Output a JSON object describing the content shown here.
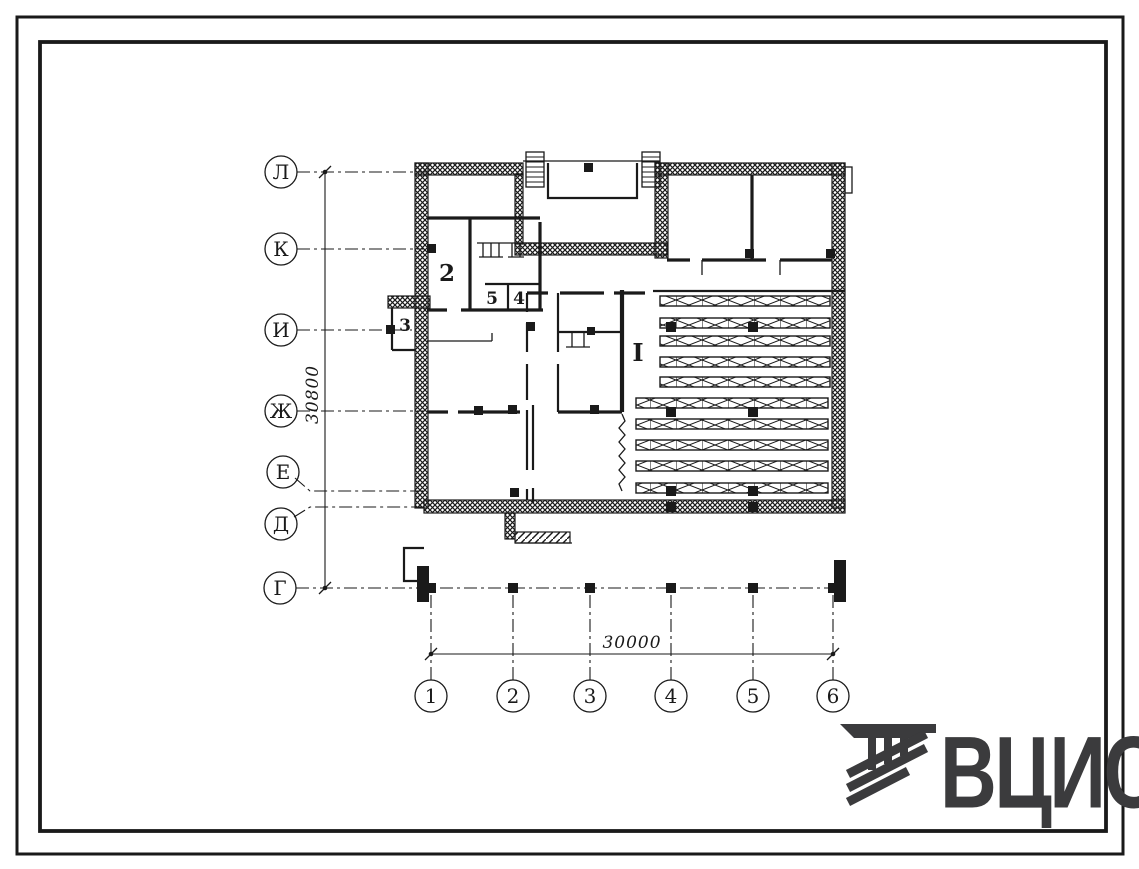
{
  "sheet": {
    "row_axes": [
      "Л",
      "К",
      "И",
      "Ж",
      "Е",
      "Д",
      "Г"
    ],
    "col_axes": [
      "1",
      "2",
      "3",
      "4",
      "5",
      "6"
    ],
    "dim_vertical": "30800",
    "dim_horizontal": "30000",
    "rooms": {
      "hall": "I",
      "room2": "2",
      "room3": "3",
      "room5": "5",
      "room4": "4"
    }
  },
  "logo": {
    "text": "ВЦИС"
  },
  "colors": {
    "ink": "#1a1a1a",
    "logo_gray": "#3b3b3d",
    "paper": "#ffffff"
  }
}
